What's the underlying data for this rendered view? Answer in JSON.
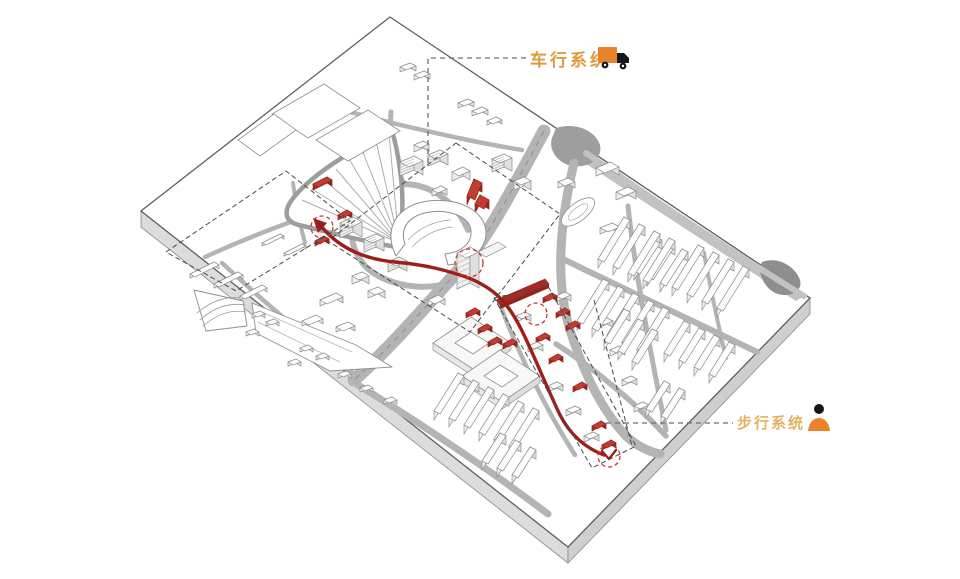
{
  "scene": {
    "background": "#ffffff",
    "description": "axonometric urban site plate diagram"
  },
  "legend": {
    "vehicle": {
      "label": "车行系统",
      "color": "#DE9A3F",
      "icon": "truck-icon"
    },
    "pedestrian": {
      "label": "步行系统",
      "color": "#E3B45F",
      "icon": "person-icon"
    }
  },
  "palette": {
    "route_red": "#9E1F1A",
    "highlight_top": "#C23C30",
    "highlight_front": "#A32B22",
    "highlight_side": "#8F251D",
    "node_red": "#C0392B",
    "road_gray": "#B4B4B4",
    "road_light": "#C2C2C2",
    "road_center": "#8A8A8A",
    "plate_stroke": "#5E5E5E",
    "plate_side": "#DCDCDC",
    "plate_side_dark": "#CFCFCF",
    "building_top": "#FDFDFD",
    "building_front": "#EFEFEF",
    "building_side": "#E0E0E0",
    "building_stroke": "#8F8F8F",
    "boundary_dash": "#4A4A4A",
    "leader_dash": "#6E6E6E",
    "terrain_gray": "#9E9E9E",
    "rail_gray": "#ADADAD",
    "truck_orange": "#E8822B",
    "icon_black": "#16161C"
  }
}
